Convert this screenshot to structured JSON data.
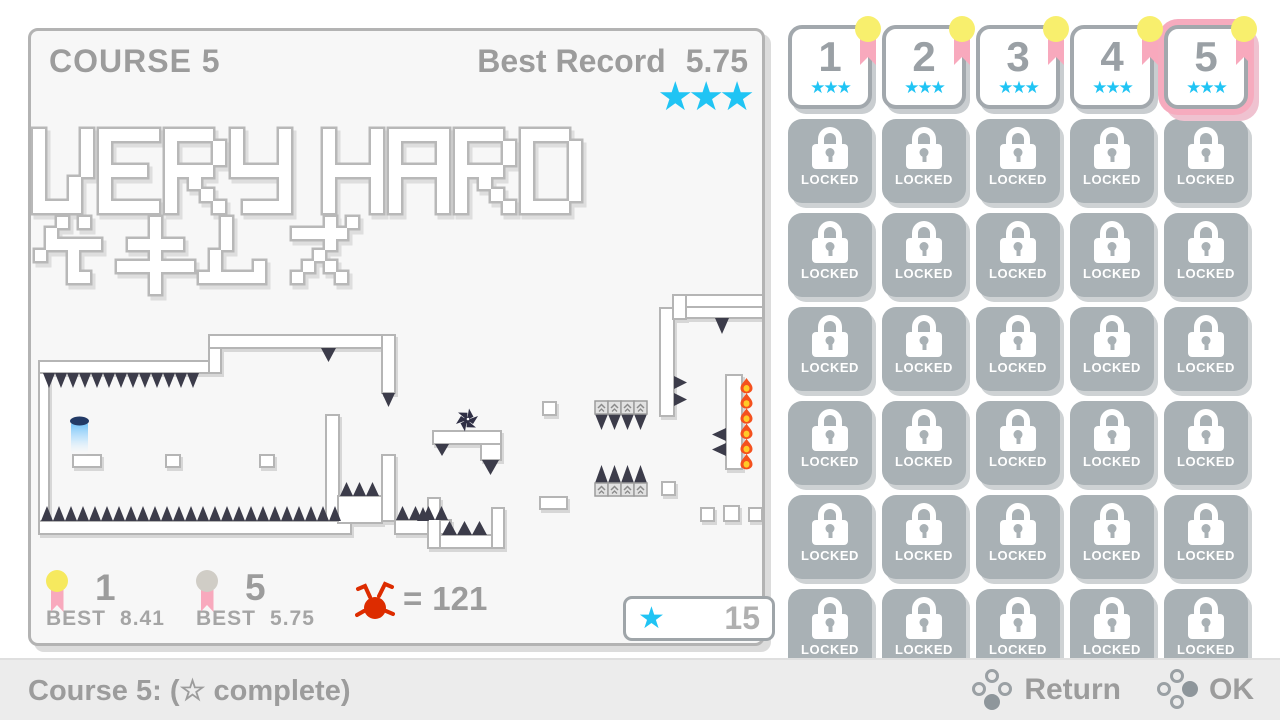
{
  "course_panel": {
    "title": "COURSE 5",
    "best_record_label": "Best Record",
    "best_record_value": "5.75",
    "record_stars": "★★★",
    "difficulty_en": "VERY HARD",
    "difficulty_ja": "ゲキムズ",
    "medals": [
      {
        "rank": "1",
        "best_label": "BEST",
        "best_value": "8.41",
        "color": "#f6e95e"
      },
      {
        "rank": "5",
        "best_label": "BEST",
        "best_value": "5.75",
        "color": "#d0cdc6"
      }
    ],
    "death_counter": {
      "equals_sign": "=",
      "count": "121"
    },
    "star_counter": {
      "star": "★",
      "count": "15"
    }
  },
  "course_grid": {
    "unlocked_courses": [
      {
        "number": "1",
        "stars": "★★★"
      },
      {
        "number": "2",
        "stars": "★★★"
      },
      {
        "number": "3",
        "stars": "★★★"
      },
      {
        "number": "4",
        "stars": "★★★"
      },
      {
        "number": "5",
        "stars": "★★★"
      }
    ],
    "selected_course": "5",
    "locked_label": "LOCKED",
    "locked_count": 30
  },
  "bottom_bar": {
    "status_text": "Course 5: (☆ complete)",
    "hints": [
      {
        "label": "Return",
        "filled_button": "bottom"
      },
      {
        "label": "OK",
        "filled_button": "right"
      }
    ]
  },
  "colors": {
    "cyan": "#20c4f4",
    "pink": "#f8a9bd",
    "yellow": "#f8ef6d",
    "gray_text": "#9c9c9c",
    "locked_gray": "#a9b1b5",
    "spike": "#3c3c4a",
    "fire_orange": "#f4511e",
    "fire_yellow": "#ffca28",
    "death_red": "#dd2c00",
    "player_blue": "#53b5f7"
  }
}
